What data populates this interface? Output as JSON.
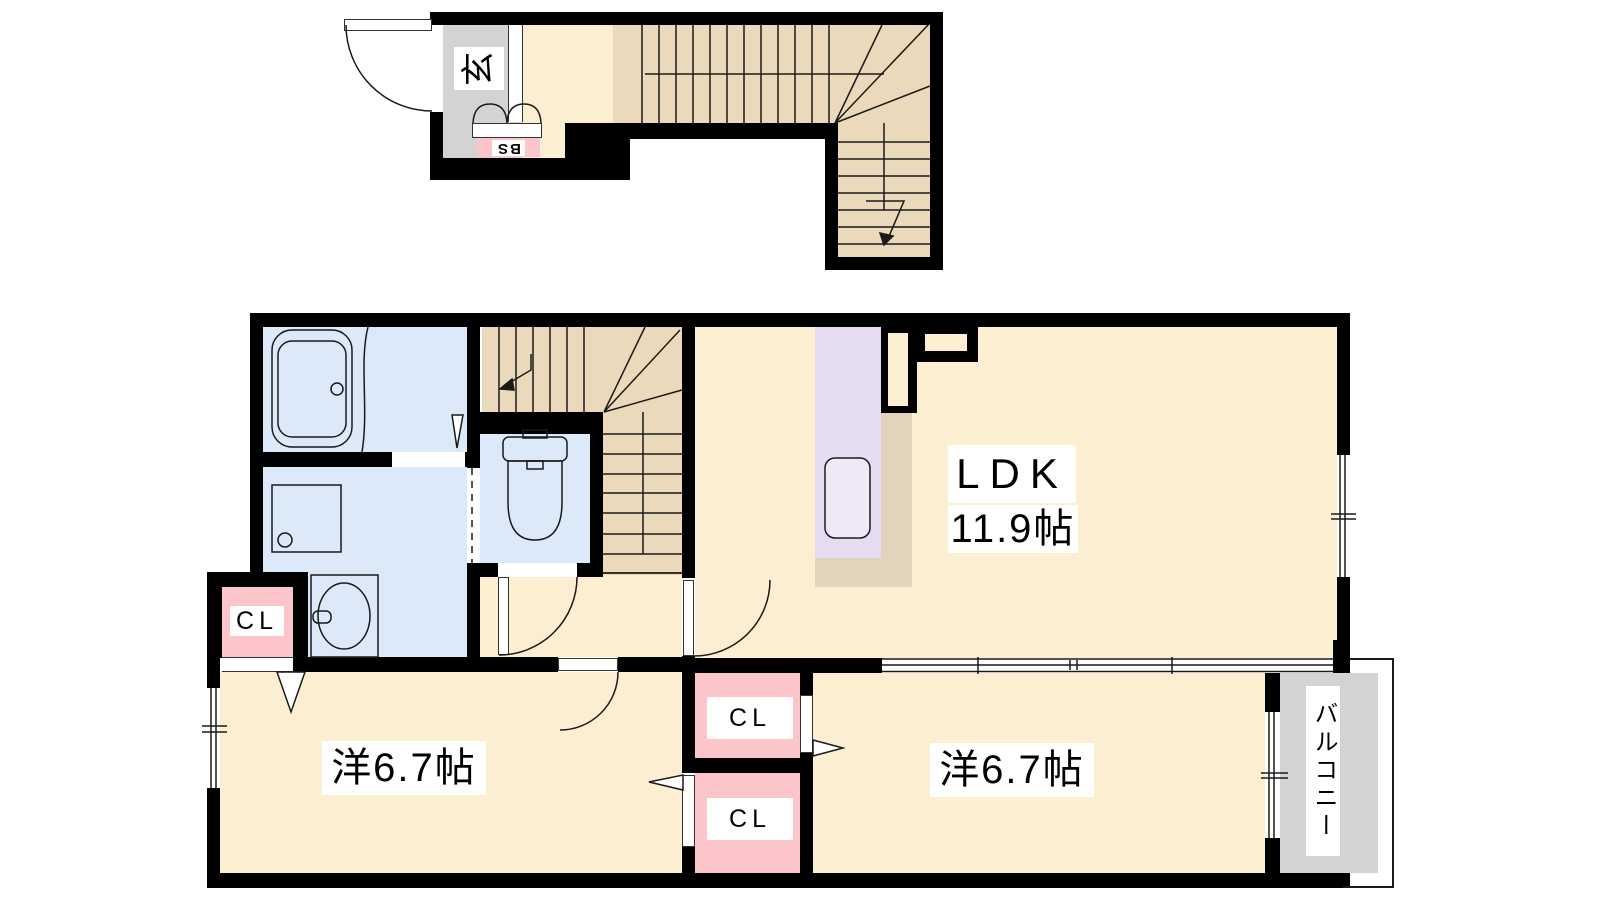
{
  "labels": {
    "entrance": "玄",
    "shoe_box": "SB",
    "ldk": "LDK",
    "ldk_size": "11.9帖",
    "bedroom_left": "洋6.7帖",
    "bedroom_right": "洋6.7帖",
    "closet": "CL",
    "balcony": "バルコニー"
  },
  "colors": {
    "wall": "#000000",
    "floor_main": "#FCEED0",
    "floor_stairs": "#EAD9BA",
    "floor_wet": "#DCE9F8",
    "floor_closet": "#FBC5CA",
    "floor_kitchen": "#E6DCF2",
    "floor_entrance": "#D3D3D3",
    "floor_balcony": "#D3D3D3",
    "kitchen_counter": "#E2D3BC",
    "label_background": "#FFFFFF"
  }
}
